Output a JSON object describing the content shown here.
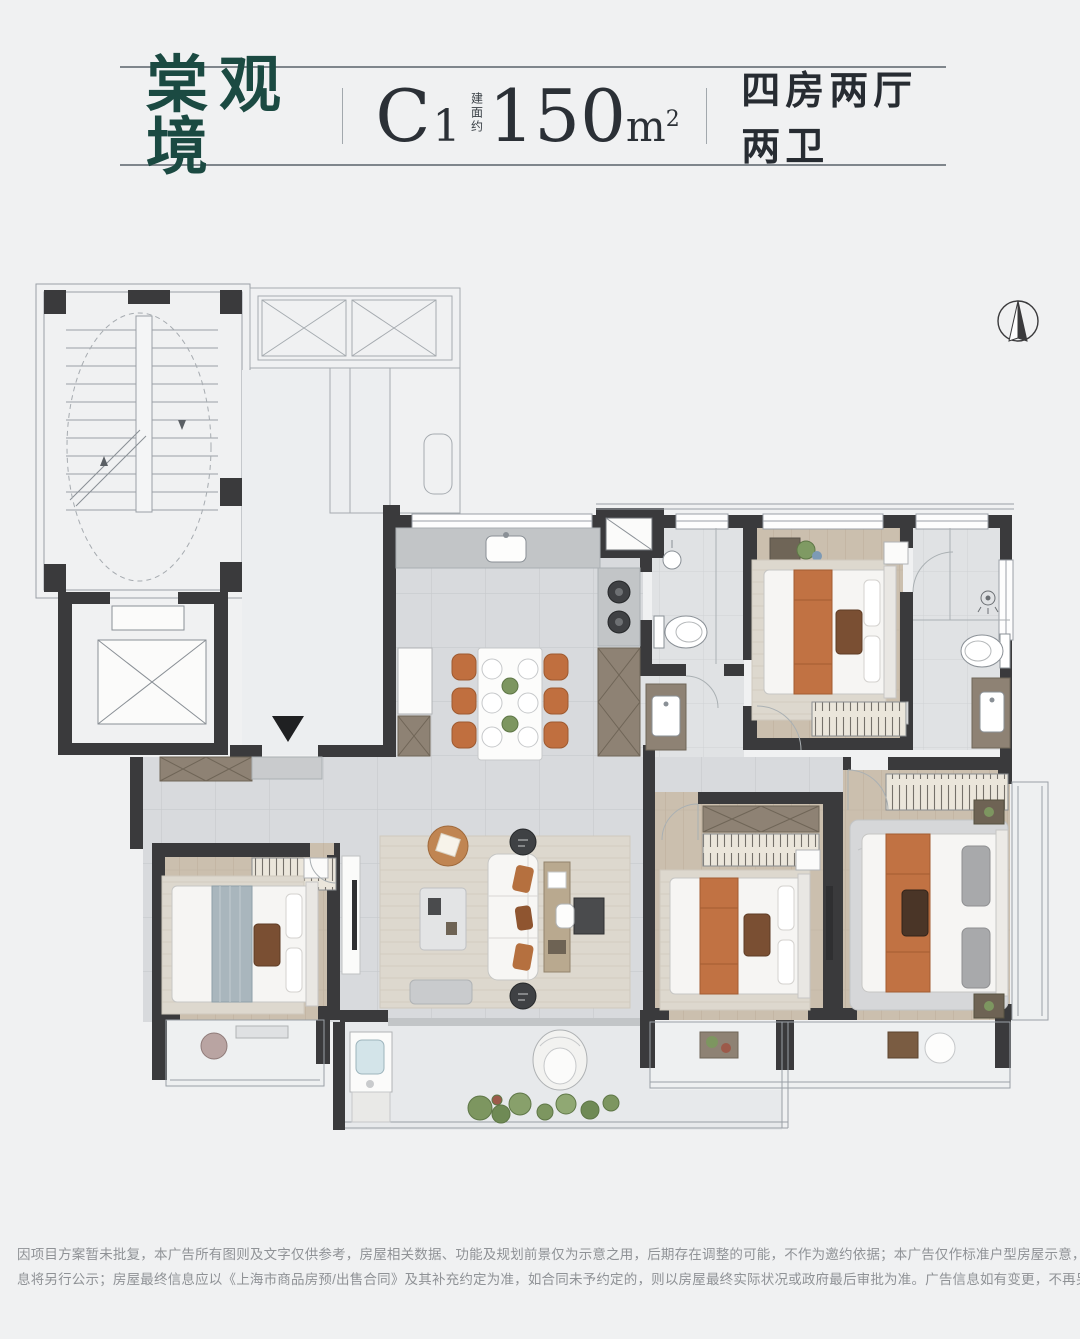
{
  "header": {
    "project_name": "棠观境",
    "unit_code": "C",
    "unit_code_sub": "1",
    "area_label_vertical": "建面约",
    "area_value": "150",
    "area_unit_letter": "m",
    "area_unit_sup": "2",
    "layout_desc": "四房两厅两卫"
  },
  "floorplan": {
    "compass_icon": "north-compass",
    "entry_marker": "entry-arrow-down",
    "text_labels": []
  },
  "footer": {
    "disclaimer_line1": "因项目方案暂未批复，本广告所有图则及文字仅供参考，房屋相关数据、功能及规划前景仅为示意之用，后期存在调整的可能，不作为邀约依据；本广告仅作标准户型房屋示意，非标准户型相关信",
    "disclaimer_line2": "息将另行公示；房屋最终信息应以《上海市商品房预/出售合同》及其补充约定为准，如合同未予约定的，则以房屋最终实际状况或政府最后审批为准。广告信息如有变更，不再另行通知。"
  },
  "theme": {
    "page_bg": "#f0f1f2",
    "wall": "#3a3a3c",
    "title_green": "#1b4a42",
    "text_dark": "#2b3036",
    "line_gray": "#7f868c",
    "disclaimer_gray": "#8f9296",
    "tile_floor": "#d8dadd",
    "wood_floor": "#cbbfae",
    "cabinet_tan": "#8e8274",
    "chair_orange": "#c06f3f",
    "plant_green": "#7d9660"
  }
}
